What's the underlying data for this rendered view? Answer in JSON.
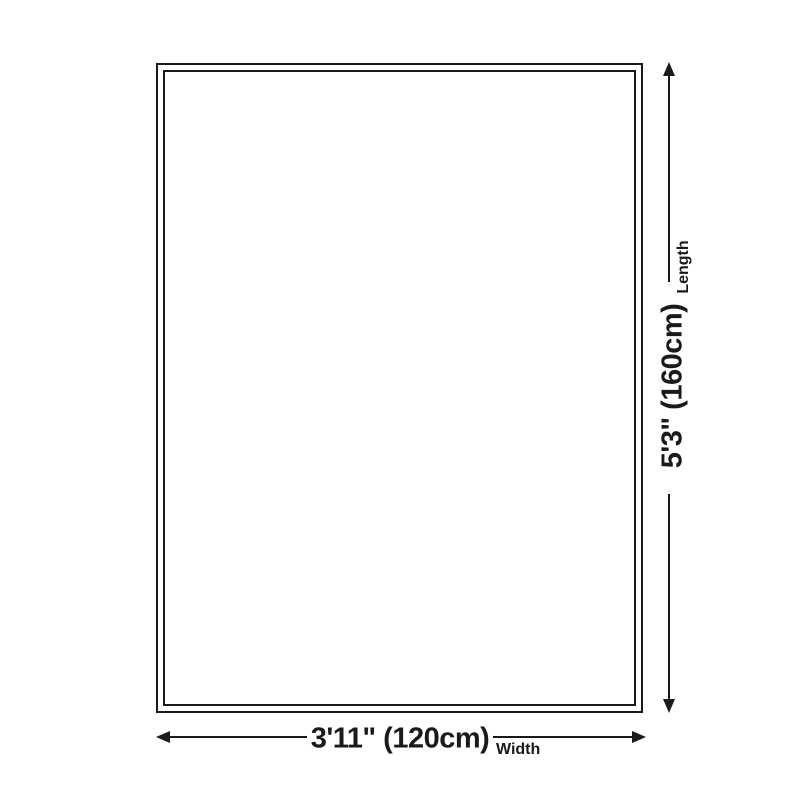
{
  "page": {
    "background_color": "#ffffff"
  },
  "diagram": {
    "type": "product-size-diagram",
    "line_color": "#1a1a1a",
    "shape": "rectangle-double-outline",
    "length": {
      "value": "5'3\" (160cm)",
      "label": "Length"
    },
    "width": {
      "value": "3'11\" (120cm)",
      "label": "Width"
    }
  }
}
